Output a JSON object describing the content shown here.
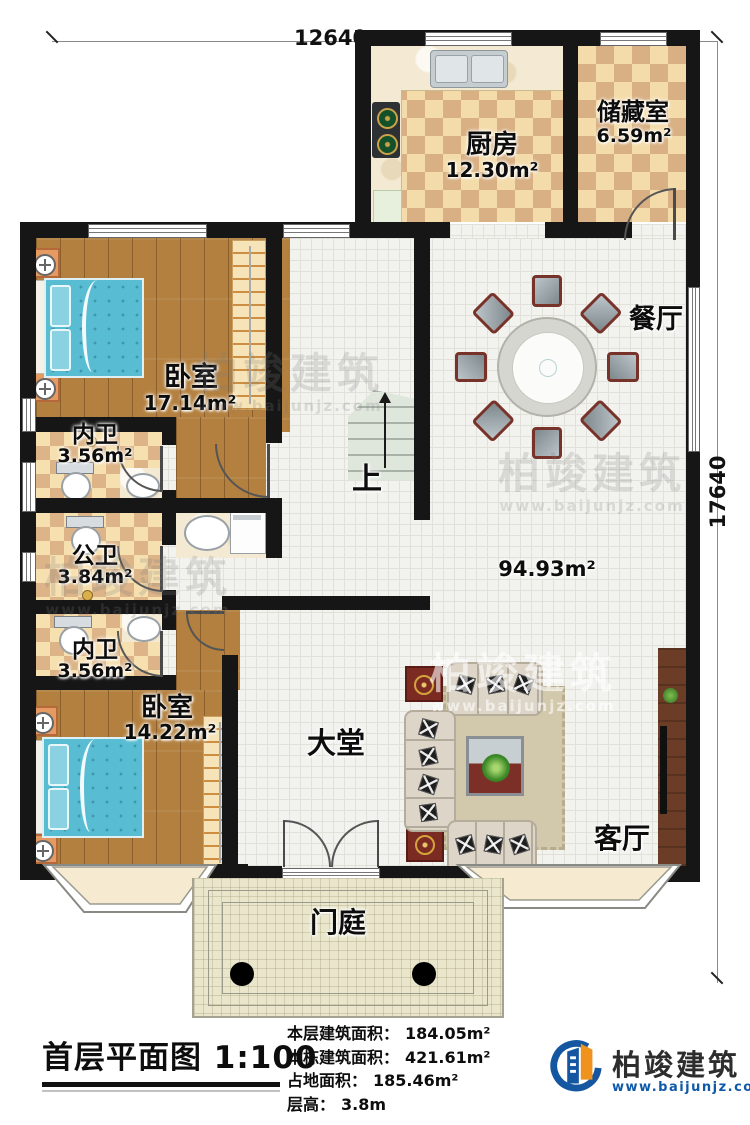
{
  "dimensions": {
    "width_label": "12640",
    "height_label": "17640"
  },
  "rooms": {
    "kitchen": {
      "label": "厨房",
      "area": "12.30m²"
    },
    "storage": {
      "label": "储藏室",
      "area": "6.59m²"
    },
    "dining": {
      "label": "餐厅"
    },
    "bedroom1": {
      "label": "卧室",
      "area": "17.14m²"
    },
    "bath_ensuite1": {
      "label": "内卫",
      "area": "3.56m²"
    },
    "bath_public": {
      "label": "公卫",
      "area": "3.84m²"
    },
    "bath_ensuite2": {
      "label": "内卫",
      "area": "3.56m²"
    },
    "bedroom2": {
      "label": "卧室",
      "area": "14.22m²"
    },
    "hall": {
      "label": "大堂",
      "area": "94.93m²"
    },
    "living": {
      "label": "客厅"
    },
    "porch": {
      "label": "门庭"
    },
    "stairs_up": {
      "label": "上"
    }
  },
  "footer": {
    "title": "首层平面图",
    "scale": "1:100",
    "stats": [
      {
        "label": "本层建筑面积：",
        "value": "184.05m²"
      },
      {
        "label": "本栋建筑面积：",
        "value": "421.61m²"
      },
      {
        "label": "占地面积：",
        "value": "185.46m²"
      },
      {
        "label": "层高：",
        "value": "3.8m"
      }
    ]
  },
  "brand": {
    "name": "柏竣建筑",
    "url": "www.baijunjz.com"
  },
  "watermark": {
    "text": "柏竣建筑",
    "url": "www.baijunjz.com"
  }
}
